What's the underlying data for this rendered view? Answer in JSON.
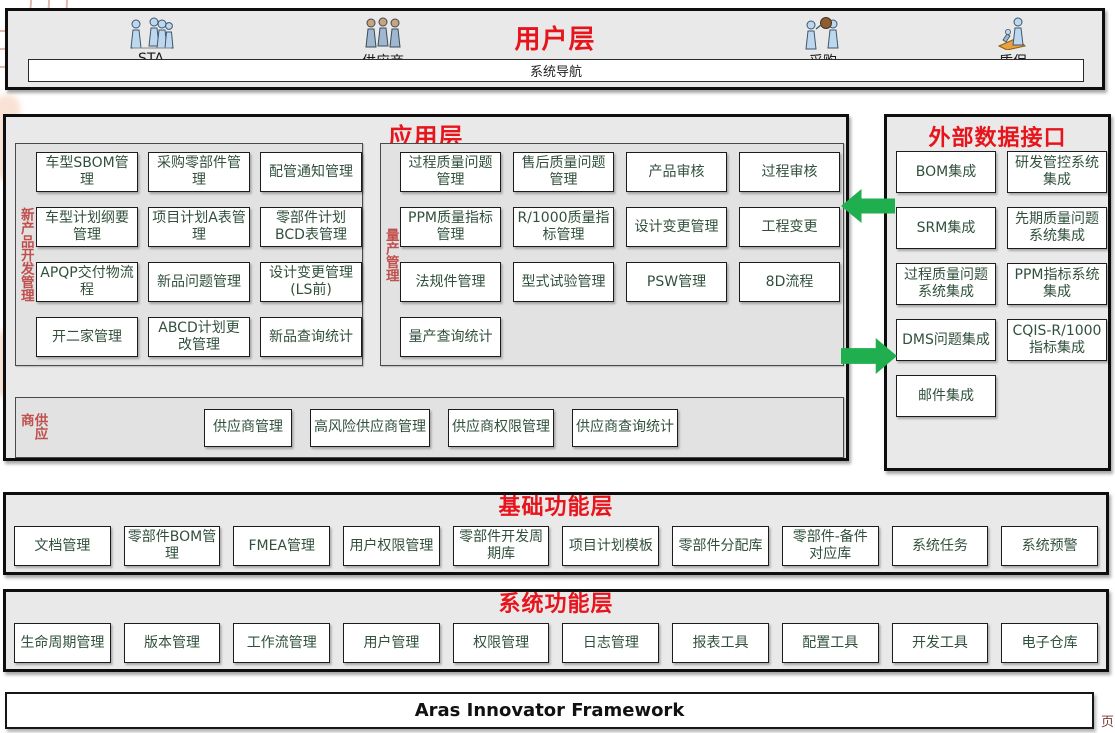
{
  "colors": {
    "layer_title_red": "#e8141b",
    "vertical_label_red": "#c0504d",
    "item_text_green": "#31503c",
    "arrow_green": "#1faf4f",
    "panel_fill": "#e9e9e9"
  },
  "user_layer": {
    "title": "用户层",
    "nav_label": "系统导航",
    "roles": [
      {
        "label": "STA",
        "icon": "people-group-icon"
      },
      {
        "label": "供应商",
        "icon": "people-group-icon"
      },
      {
        "label": "采购",
        "icon": "people-package-icon"
      },
      {
        "label": "质保",
        "icon": "person-inspect-icon"
      }
    ]
  },
  "app_layer": {
    "title": "应用层",
    "groups": [
      {
        "name": "新产品开发管理",
        "items": [
          "车型SBOM管理",
          "采购零部件管理",
          "配管通知管理",
          "车型计划纲要管理",
          "项目计划A表管理",
          "零部件计划BCD表管理",
          "APQP交付物流程",
          "新品问题管理",
          "设计变更管理(LS前)",
          "开二家管理",
          "ABCD计划更改管理",
          "新品查询统计"
        ]
      },
      {
        "name": "量产管理",
        "items": [
          "过程质量问题管理",
          "售后质量问题管理",
          "产品审核",
          "过程审核",
          "PPM质量指标管理",
          "R/1000质量指标管理",
          "设计变更管理",
          "工程变更",
          "法规件管理",
          "型式试验管理",
          "PSW管理",
          "8D流程",
          "量产查询统计"
        ]
      },
      {
        "name": "供应商",
        "items": [
          "供应商管理",
          "高风险供应商管理",
          "供应商权限管理",
          "供应商查询统计"
        ]
      }
    ]
  },
  "external_layer": {
    "title": "外部数据接口",
    "items": [
      "BOM集成",
      "研发管控系统集成",
      "SRM集成",
      "先期质量问题系统集成",
      "过程质量问题系统集成",
      "PPM指标系统集成",
      "DMS问题集成",
      "CQIS-R/1000指标集成",
      "邮件集成"
    ]
  },
  "base_layer": {
    "title": "基础功能层",
    "items": [
      "文档管理",
      "零部件BOM管理",
      "FMEA管理",
      "用户权限管理",
      "零部件开发周期库",
      "项目计划模板",
      "零部件分配库",
      "零部件-备件对应库",
      "系统任务",
      "系统预警"
    ]
  },
  "system_layer": {
    "title": "系统功能层",
    "items": [
      "生命周期管理",
      "版本管理",
      "工作流管理",
      "用户管理",
      "权限管理",
      "日志管理",
      "报表工具",
      "配置工具",
      "开发工具",
      "电子仓库"
    ]
  },
  "framework_bar": {
    "label": "Aras Innovator Framework"
  },
  "watermark": {
    "char": "页"
  }
}
